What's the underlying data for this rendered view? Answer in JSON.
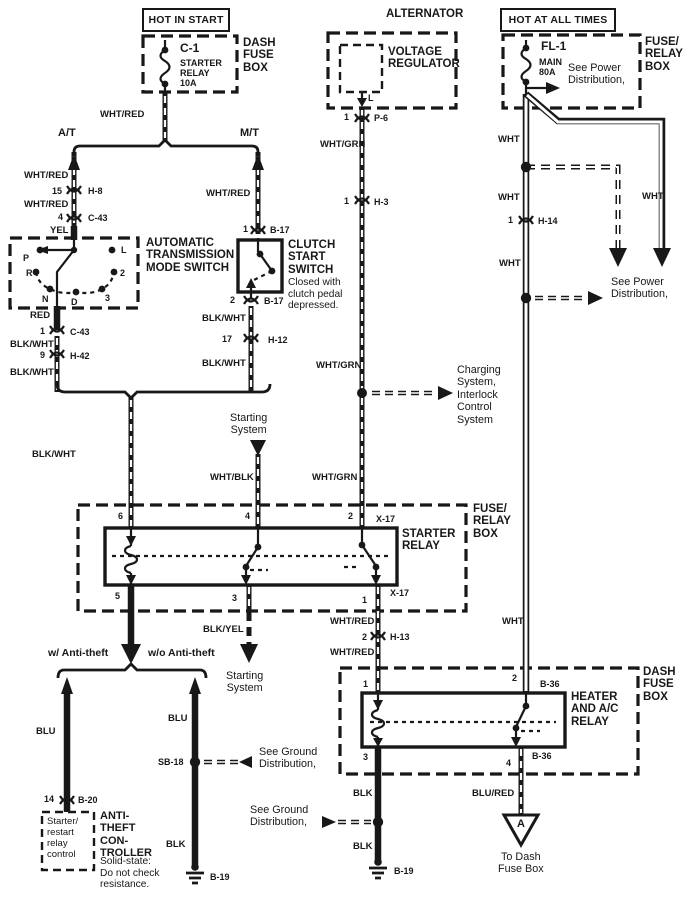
{
  "colors": {
    "ink": "#181818",
    "paper": "#ffffff"
  },
  "headers": {
    "hot_in_start": "HOT IN START",
    "hot_at_all_times": "HOT AT ALL TIMES",
    "alternator": "ALTERNATOR"
  },
  "boxes": {
    "dash_fuse_box": "DASH\nFUSE\nBOX",
    "fuse_relay_box": "FUSE/\nRELAY\nBOX"
  },
  "fuses": {
    "c1": {
      "id": "C-1",
      "desc": "STARTER\nRELAY\n10A"
    },
    "fl1": {
      "id": "FL-1",
      "desc": "MAIN\n80A"
    }
  },
  "wire_labels": {
    "wht_red": "WHT/RED",
    "blk_wht": "BLK/WHT",
    "wht": "WHT",
    "wht_grn": "WHT/GRN",
    "yel": "YEL",
    "red": "RED",
    "blk": "BLK",
    "blu": "BLU",
    "blk_yel": "BLK/YEL",
    "wht_blk": "WHT/BLK",
    "blu_red": "BLU/RED"
  },
  "branches": {
    "at": "A/T",
    "mt": "M/T",
    "with_anti_theft": "w/ Anti-theft",
    "without_anti_theft": "w/o Anti-theft"
  },
  "components": {
    "voltage_regulator": "VOLTAGE\nREGULATOR",
    "terminal_l": "L",
    "at_mode_switch": {
      "title": "AUTOMATIC\nTRANSMISSION\nMODE SWITCH",
      "positions": {
        "p": "P",
        "r": "R",
        "n": "N",
        "d": "D",
        "three": "3",
        "two": "2",
        "l": "L"
      }
    },
    "clutch_switch": {
      "title": "CLUTCH\nSTART\nSWITCH",
      "note": "Closed with\nclutch pedal\ndepressed."
    },
    "starter_relay": "STARTER\nRELAY",
    "heater_relay": "HEATER\nAND A/C\nRELAY",
    "anti_theft": {
      "title": "ANTI-\nTHEFT\nCON-\nTROLLER",
      "note": "Solid-state:\nDo not check\nresistance.",
      "inner": "Starter/\nrestart\nrelay\ncontrol"
    }
  },
  "connectors": {
    "h8": {
      "pin": "15",
      "name": "H-8"
    },
    "c43_upper": {
      "pin": "4",
      "name": "C-43"
    },
    "c43_lower": {
      "pin": "1",
      "name": "C-43"
    },
    "h42": {
      "pin": "9",
      "name": "H-42"
    },
    "b17_upper": {
      "pin": "1",
      "name": "B-17"
    },
    "b17_lower": {
      "pin": "2",
      "name": "B-17"
    },
    "h12": {
      "pin": "17",
      "name": "H-12"
    },
    "p6": {
      "pin": "1",
      "name": "P-6"
    },
    "h3": {
      "pin": "1",
      "name": "H-3"
    },
    "h14": {
      "pin": "1",
      "name": "H-14"
    },
    "h13": {
      "pin": "2",
      "name": "H-13"
    },
    "b20": {
      "pin": "14",
      "name": "B-20"
    },
    "sb18": "SB-18",
    "x17": "X-17",
    "b36": "B-36",
    "b19": "B-19"
  },
  "terminals": {
    "starter": {
      "t6": "6",
      "t4": "4",
      "t2": "2",
      "t5": "5",
      "t3": "3",
      "t1": "1"
    },
    "heater": {
      "t1": "1",
      "t2": "2",
      "t3": "3",
      "t4": "4"
    }
  },
  "references": {
    "see_power": "See Power\nDistribution,",
    "see_ground": "See Ground\nDistribution,",
    "charging": "Charging\nSystem,\nInterlock\nControl\nSystem",
    "starting_system": "Starting\nSystem",
    "to_dash_fuse_box": "To Dash\nFuse Box",
    "triangle_a": "A"
  }
}
